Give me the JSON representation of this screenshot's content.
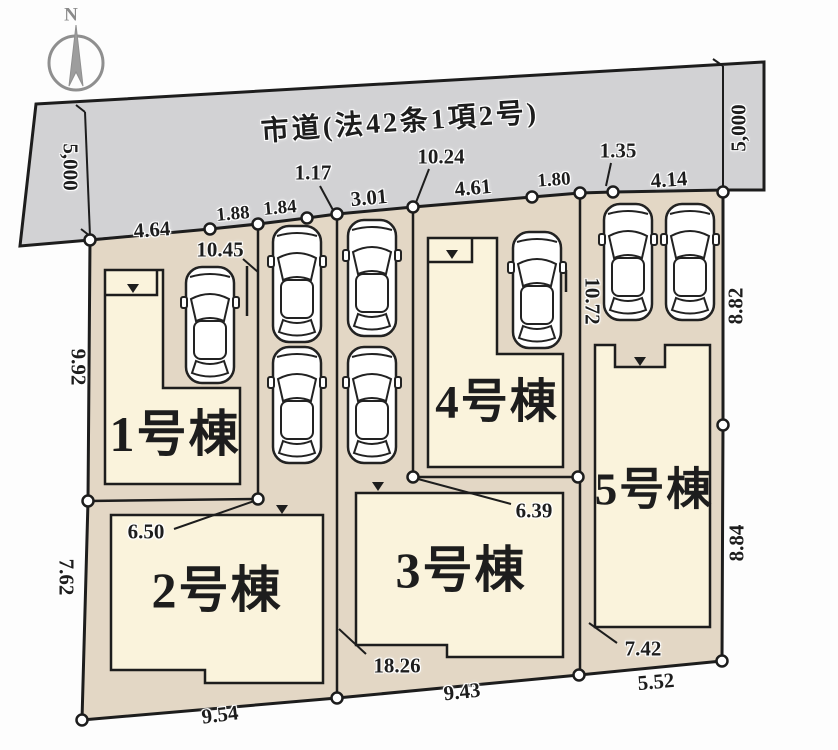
{
  "title": "区画図 (site plan)",
  "compass": {
    "north": "N"
  },
  "road": {
    "name": "市道(法42条1項2号)",
    "width_left": "5,000",
    "width_right": "5,000"
  },
  "lots": [
    {
      "label": "1号棟"
    },
    {
      "label": "2号棟"
    },
    {
      "label": "3号棟"
    },
    {
      "label": "4号棟"
    },
    {
      "label": "5号棟"
    }
  ],
  "labels": {
    "road_name": "市道(法42条1項2号)",
    "north": "N",
    "road_width_left": "5,000",
    "road_width_right": "5,000",
    "d464": "4.64",
    "d188": "1.88",
    "d184": "1.84",
    "d117": "1.17",
    "d301": "3.01",
    "d1024": "10.24",
    "d461": "4.61",
    "d180": "1.80",
    "d135": "1.35",
    "d414": "4.14",
    "d992": "9.92",
    "d762": "7.62",
    "d882": "8.82",
    "d884": "8.84",
    "d1045": "10.45",
    "d1072": "10.72",
    "d650": "6.50",
    "d639": "6.39",
    "d1826": "18.26",
    "d742": "7.42",
    "d954": "9.54",
    "d943": "9.43",
    "d552": "5.52",
    "lot1": "1号棟",
    "lot2": "2号棟",
    "lot3": "3号棟",
    "lot4": "4号棟",
    "lot5": "5号棟"
  },
  "colors": {
    "road_fill": "#d2d2d4",
    "lot_fill": "#e3d7c5",
    "building_fill": "#faf3dc",
    "line": "#1d1d1d",
    "compass_gray": "#8f8f8f"
  }
}
